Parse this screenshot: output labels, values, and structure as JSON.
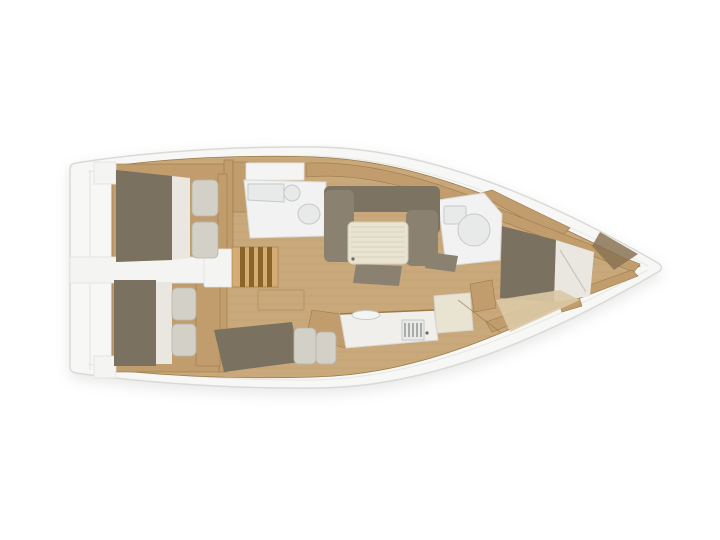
{
  "app": {
    "background": "#ffffff",
    "type": "boat-floorplan",
    "view": "top-down, bow to the right"
  },
  "colors": {
    "hullFill": "#f7f7f5",
    "hullStroke": "#d9d9d7",
    "deckLine": "#e6e6e3",
    "floorWood": "#c9a97b",
    "plankLine": "#a98454",
    "woodCabinet": "#c19d6d",
    "woodTrim": "#9b7a48",
    "stepsBase": "#d3ad74",
    "stepsBar": "#8a6428",
    "mattress": "#7b7161",
    "mattressDark": "#8a7354",
    "sofaSeat": "#8b8171",
    "sofaBack": "#7d7363",
    "bedding": "#e9e7e0",
    "pillow": "#d3d0c7",
    "pillowStroke": "#b7b4a9",
    "table": "#e9e3d1",
    "tableLine": "#d5cdb7",
    "whiteDeck": "#f4f4f2",
    "whiteDeckStroke": "#e2e2e0",
    "roomFloor": "#f1f2f1",
    "roomStroke": "#d8dad8",
    "fixture": "#e8eae9",
    "fixtureStroke": "#c6c9c7",
    "counter": "#f0efeb",
    "counterStroke": "#d9d7d1",
    "stoveBar": "#6b6b64",
    "lightFloor": "#dcc9a5"
  },
  "regions": {
    "hull": "hull outline",
    "swim_platform": "stern swim platform",
    "cockpit": "cockpit walkway",
    "steps": "companionway steps",
    "aft_cabin_top": "aft double cabin (upper)",
    "aft_cabin_bottom": "aft double cabin (lower)",
    "berth_mid": "midship berth",
    "head_aft": "aft head with washbasin and toilet",
    "head_fwd": "forward head with shower",
    "salon": "salon with L-shaped sofa and table",
    "galley": "galley with sink and stove",
    "nav": "chart table",
    "fwd_cabin": "forward owner cabin with double berth"
  }
}
